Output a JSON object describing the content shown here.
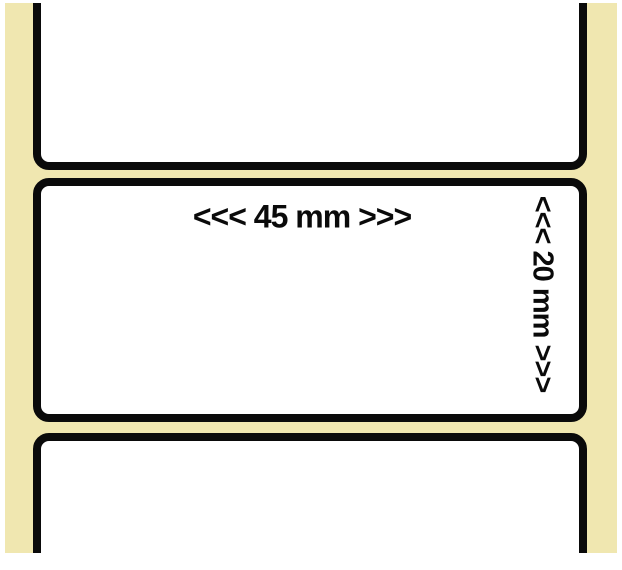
{
  "image": {
    "width_dimension": "<<< 45 mm >>>",
    "height_dimension": "<<< 20 mm >>>",
    "colors": {
      "backing_paper": "#f0e7b0",
      "label_face": "#ffffff",
      "label_border": "#0a0a0a",
      "page_background": "#ffffff"
    }
  }
}
